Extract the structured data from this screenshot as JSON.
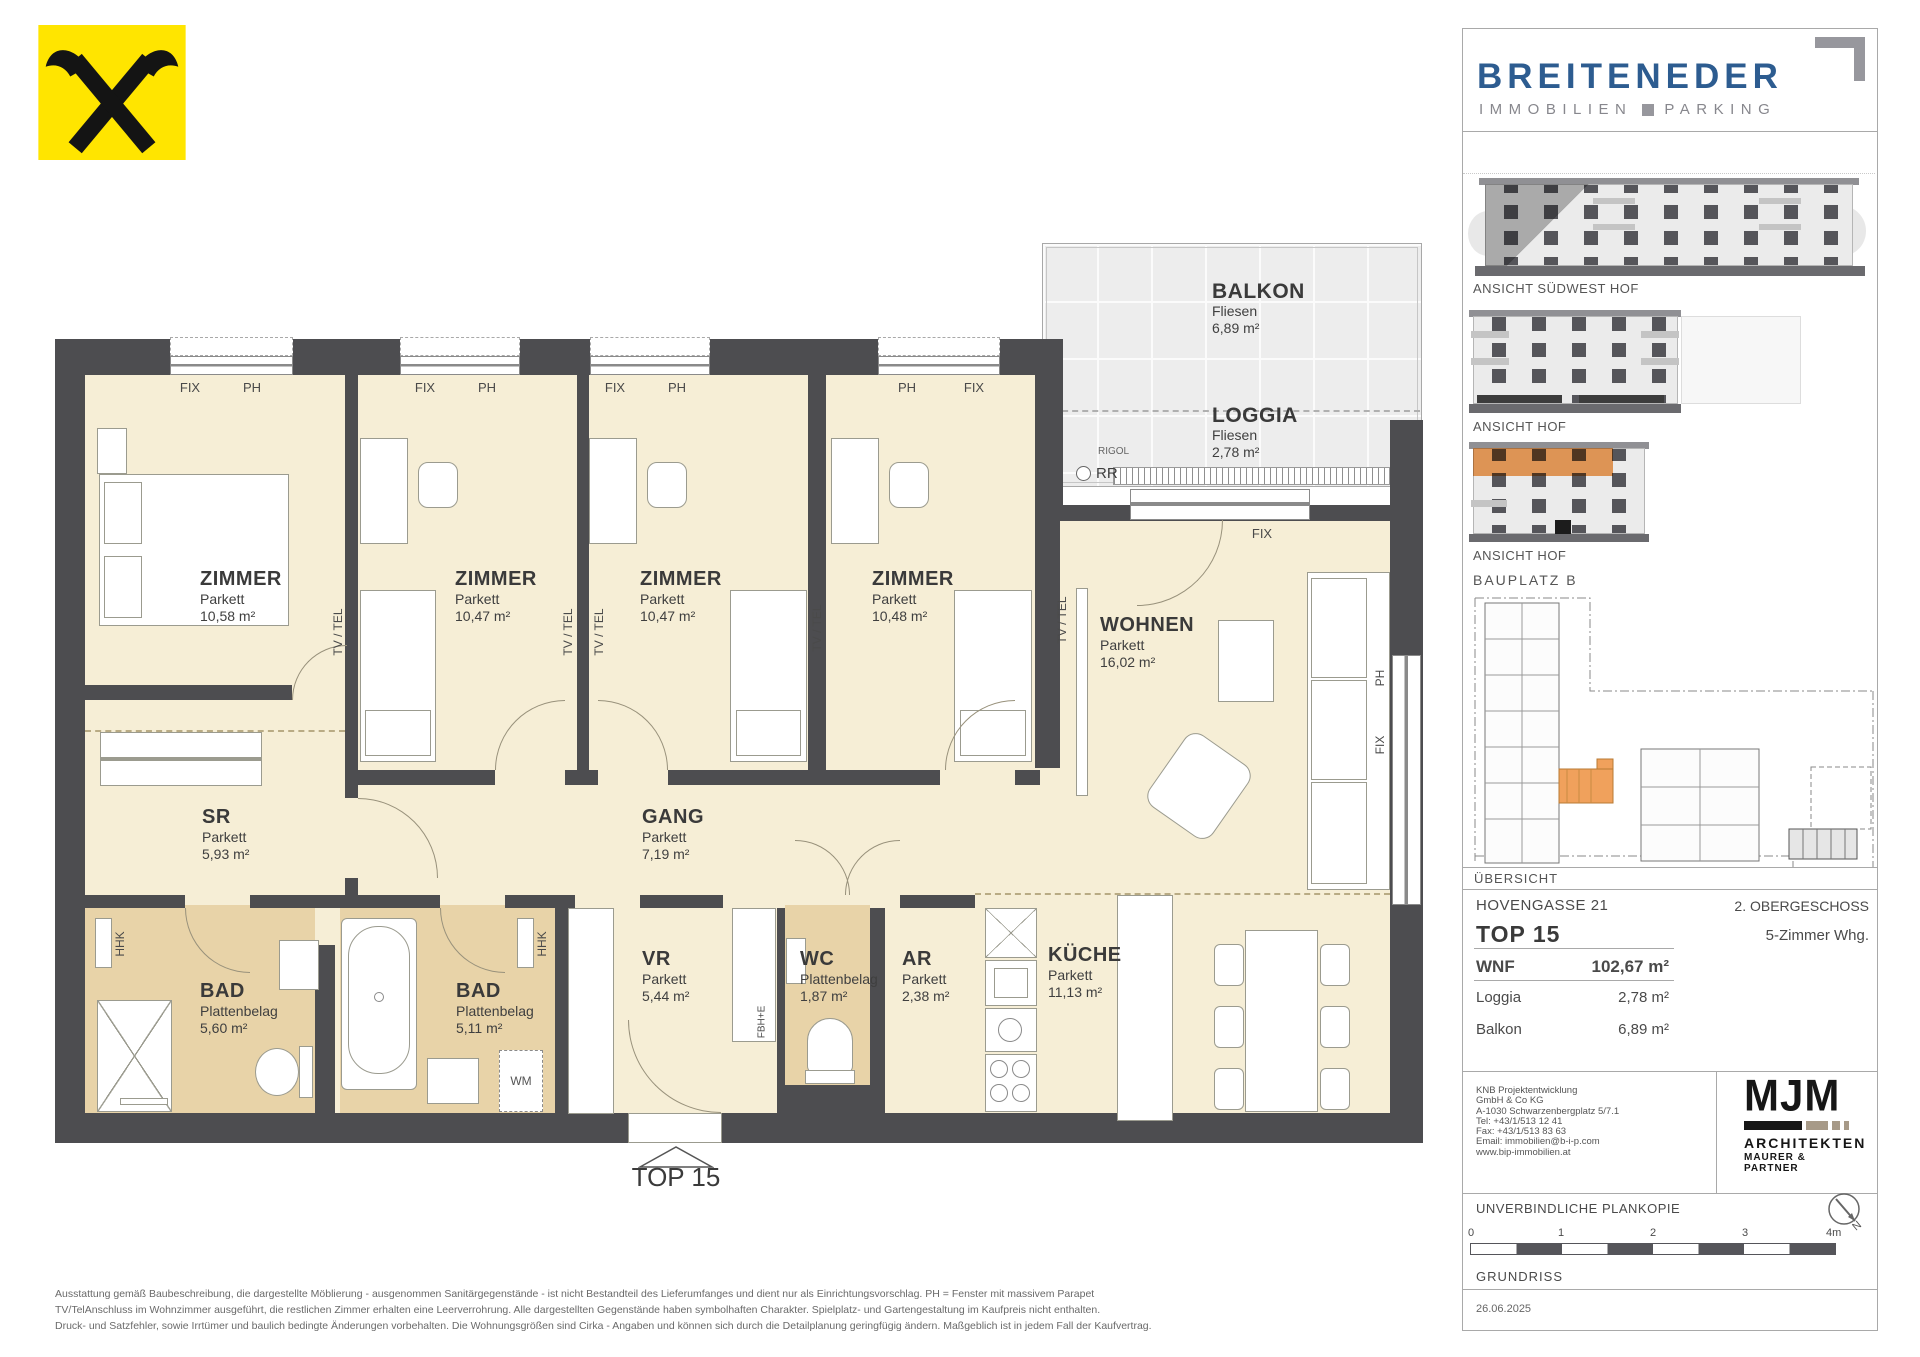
{
  "colors": {
    "wall_gray": "#4D4D50",
    "room_cream": "#F6EED6",
    "wet_room_tan": "#E8D3A8",
    "accent_orange": "#F0A15C",
    "raiffeisen_yellow": "#FFE500",
    "brand_blue": "#2D5C90"
  },
  "plan": {
    "unit_label": "TOP 15",
    "rooms": {
      "z1": {
        "name": "ZIMMER",
        "floor": "Parkett",
        "area": "10,58 m²"
      },
      "z2": {
        "name": "ZIMMER",
        "floor": "Parkett",
        "area": "10,47 m²"
      },
      "z3": {
        "name": "ZIMMER",
        "floor": "Parkett",
        "area": "10,47 m²"
      },
      "z4": {
        "name": "ZIMMER",
        "floor": "Parkett",
        "area": "10,48 m²"
      },
      "wohnen": {
        "name": "WOHNEN",
        "floor": "Parkett",
        "area": "16,02 m²"
      },
      "sr": {
        "name": "SR",
        "floor": "Parkett",
        "area": "5,93 m²"
      },
      "gang": {
        "name": "GANG",
        "floor": "Parkett",
        "area": "7,19 m²"
      },
      "bad1": {
        "name": "BAD",
        "floor": "Plattenbelag",
        "area": "5,60 m²"
      },
      "bad2": {
        "name": "BAD",
        "floor": "Plattenbelag",
        "area": "5,11 m²"
      },
      "vr": {
        "name": "VR",
        "floor": "Parkett",
        "area": "5,44 m²"
      },
      "wc": {
        "name": "WC",
        "floor": "Pl​attenbelag",
        "area": "1,87 m²"
      },
      "ar": {
        "name": "AR",
        "floor": "Parkett",
        "area": "2,38 m²"
      },
      "kueche": {
        "name": "KÜCHE",
        "floor": "Parkett",
        "area": "11,13 m²"
      },
      "balkon": {
        "name": "BALKON",
        "floor": "Fliesen",
        "area": "6,89 m²"
      },
      "loggia": {
        "name": "LOGGIA",
        "floor": "Fliesen",
        "area": "2,78 m²"
      }
    },
    "marks": {
      "fix": "FIX",
      "ph": "PH",
      "tvtel": "TV / TEL",
      "hhk": "HHK",
      "fbhe": "FBH+E",
      "rigol": "RIGOL",
      "rr": "RR",
      "wm": "WM"
    }
  },
  "sidebar": {
    "brand": {
      "name": "BREITENEDER",
      "tagline_left": "IMMOBILIEN",
      "tagline_right": "PARKING"
    },
    "elevation_labels": {
      "a": "ANSICHT SÜDWEST HOF",
      "b": "ANSICHT HOF",
      "c": "ANSICHT HOF"
    },
    "siteplan_label": "BAUPLATZ  B",
    "overview_label": "ÜBERSICHT",
    "project": {
      "street": "HOVENGASSE 21",
      "level": "2. OBERGESCHOSS",
      "unit": "TOP 15",
      "unit_type": "5-Zimmer Whg.",
      "wnf_label": "WNF",
      "wnf_value": "102,67 m²",
      "rows": [
        {
          "label": "Loggia",
          "value": "2,78 m²"
        },
        {
          "label": "Balkon",
          "value": "6,89 m²"
        }
      ]
    },
    "developer_lines": [
      "KNB Projektentwicklung",
      "GmbH & Co KG",
      "A-1030 Schwarzenbergplatz 5/7.1",
      "Tel: +43/1/513 12 41",
      "Fax: +43/1/513 83 63",
      "Email: immobilien@b-i-p.com",
      "www.bip-immobilien.at"
    ],
    "architect": {
      "mark": "MJM",
      "line1": "ARCHITEKTEN",
      "line2": "MAURER & PARTNER"
    },
    "plan_copy": "UNVERBINDLICHE PLANKOPIE",
    "compass_n": "N",
    "scale_ticks": [
      "0",
      "1",
      "2",
      "3",
      "4m"
    ],
    "drawing_type": "GRUNDRISS",
    "date": "26.06.2025"
  },
  "footer": {
    "lines": [
      "Ausstattung gemäß Baubeschreibung, die dargestellte Möblierung - ausgenommen Sanitärgegenstände - ist nicht Bestandteil des Lieferumfanges und dient nur als Einrichtungsvorschlag. PH = Fenster mit massivem Parapet",
      "TV/TelAnschluss im Wohnzimmer ausgeführt, die restlichen Zimmer erhalten eine Leerverrohrung. Alle dargestellten Gegenstände haben symbolhaften Charakter. Spielplatz- und Gartengestaltung im Kaufpreis nicht enthalten.",
      "Druck- und Satzfehler, sowie Irrtümer und baulich bedingte Änderungen vorbehalten. Die Wohnungsgrößen sind Cirka - Angaben und können sich durch die Detailplanung geringfügig ändern. Maßgeblich ist in jedem Fall der Kaufvertrag."
    ]
  }
}
